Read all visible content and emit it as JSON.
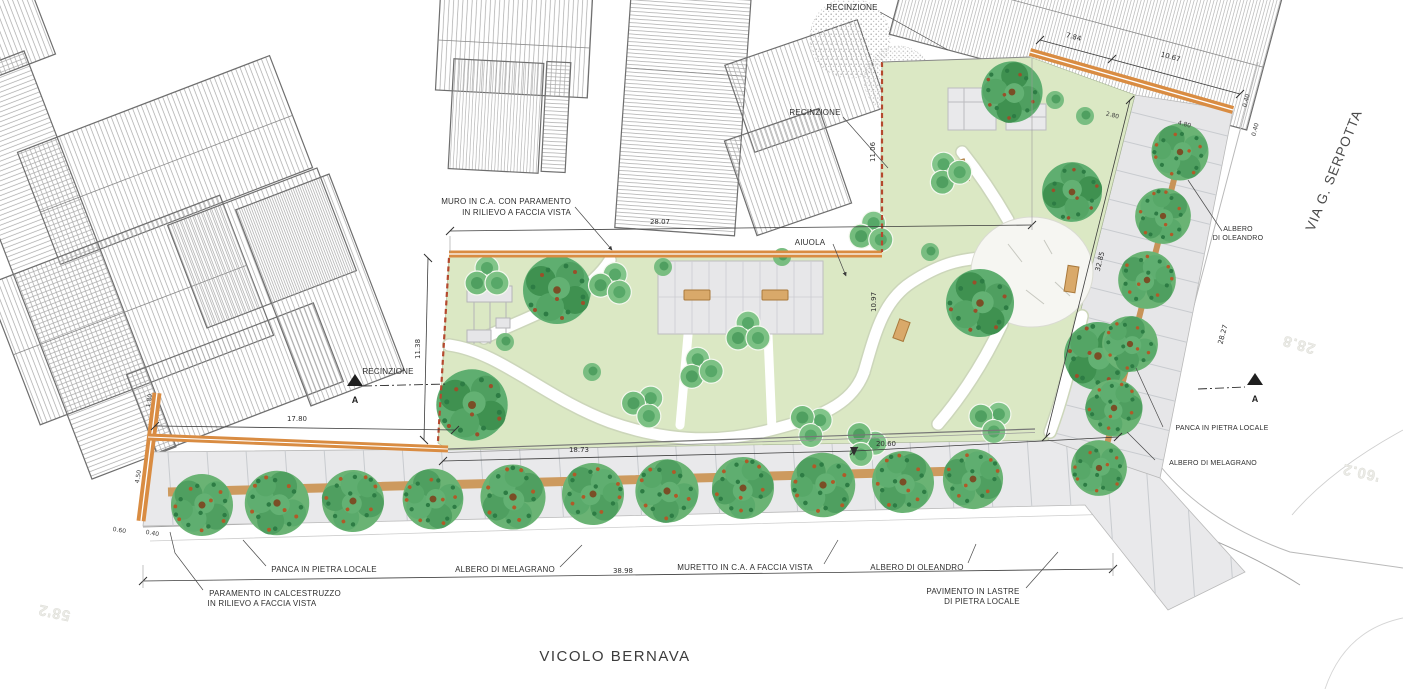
{
  "plan": {
    "streets": {
      "bottom": "VICOLO BERNAVA",
      "right": "VIA G. SERPOTTA"
    },
    "walls": {
      "muro_1": "MURO IN C.A. CON PARAMENTO",
      "muro_2": "IN RILIEVO A FACCIA VISTA",
      "muretto": "MURETTO IN C.A. A FACCIA VISTA",
      "paramento_1": "PARAMENTO IN CALCESTRUZZO",
      "paramento_2": "IN RILIEVO A FACCIA VISTA",
      "recinzione": "RECINZIONE"
    },
    "features": {
      "aiuola": "AIUOLA",
      "panca": "PANCA IN PIETRA LOCALE",
      "albero_melagrano": "ALBERO DI MELAGRANO",
      "albero_oleandro": "ALBERO DI OLEANDRO",
      "albero_1": "ALBERO",
      "albero_2": "DI OLEANDRO",
      "pavimento_1": "PAVIMENTO IN LASTRE",
      "pavimento_2": "DI PIETRA LOCALE"
    },
    "section_marker": "A",
    "dims": {
      "top": "28.07",
      "left": "17.80",
      "left_v": "11.38",
      "mid_v": "11.06",
      "inner_v": "10.97",
      "bot1": "18.73",
      "bot2": "20.60",
      "bot_total": "38.98",
      "tr1": "7.84",
      "tr2": "10.67",
      "strip": "32.85",
      "street": "28.27",
      "s1": "2.80",
      "s2": "4.80",
      "s3": "0.40",
      "s4": "0.40",
      "s5": "0.60",
      "s6": "0.40",
      "s7": "1.80",
      "s8": "4.50"
    },
    "underlay": {
      "a": "58'2",
      "b": "28.8",
      "c": "'60.2"
    },
    "colors": {
      "lawn": "#dbe8c4",
      "wall_orange": "#d98c42",
      "boundary_red": "#b5492e",
      "paving": "#e9e9eb",
      "tree_green": "#4f9f60",
      "bench_tan": "#d9a96a"
    }
  }
}
